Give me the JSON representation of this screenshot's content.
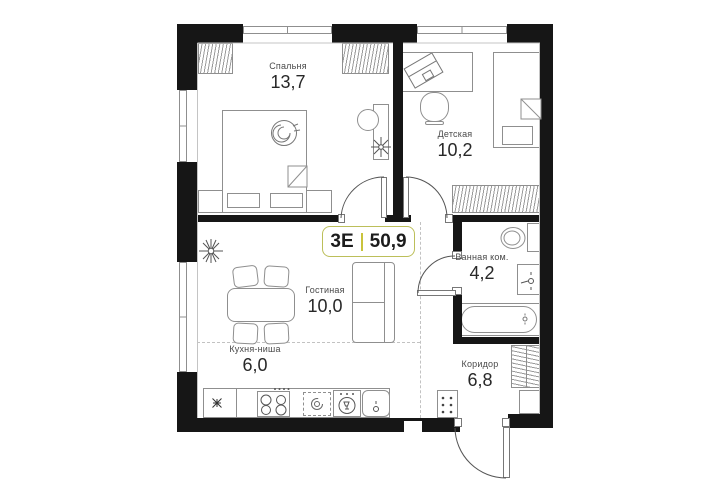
{
  "plan": {
    "title_badge": {
      "type": "3Е",
      "area": "50,9"
    },
    "rooms": [
      {
        "key": "bedroom",
        "name": "Спальня",
        "area": "13,7"
      },
      {
        "key": "children",
        "name": "Детская",
        "area": "10,2"
      },
      {
        "key": "living",
        "name": "Гостиная",
        "area": "10,0"
      },
      {
        "key": "kitchen",
        "name": "Кухня-ниша",
        "area": "6,0"
      },
      {
        "key": "bathroom",
        "name": "Ванная ком.",
        "area": "4,2"
      },
      {
        "key": "corridor",
        "name": "Коридор",
        "area": "6,8"
      }
    ],
    "colors": {
      "wall": "#161616",
      "furniture_line": "#8f8f8f",
      "badge_border": "#bcbf5a",
      "badge_divider": "#c9c33c",
      "dashed_line": "#c2c2c2",
      "background": "#ffffff"
    },
    "furniture": [
      "double-bed",
      "wardrobes",
      "bedside-dresser",
      "work-desk",
      "desk-chair",
      "plant",
      "single-bed",
      "pillow",
      "dining-table",
      "four-chairs",
      "sofa",
      "fridge",
      "cooktop",
      "dishwasher-niche",
      "washing-machine",
      "kitchen-sink",
      "electrical-panel",
      "hall-wardrobe",
      "hall-cabinet",
      "toilet",
      "washbasin",
      "bathtub"
    ]
  }
}
